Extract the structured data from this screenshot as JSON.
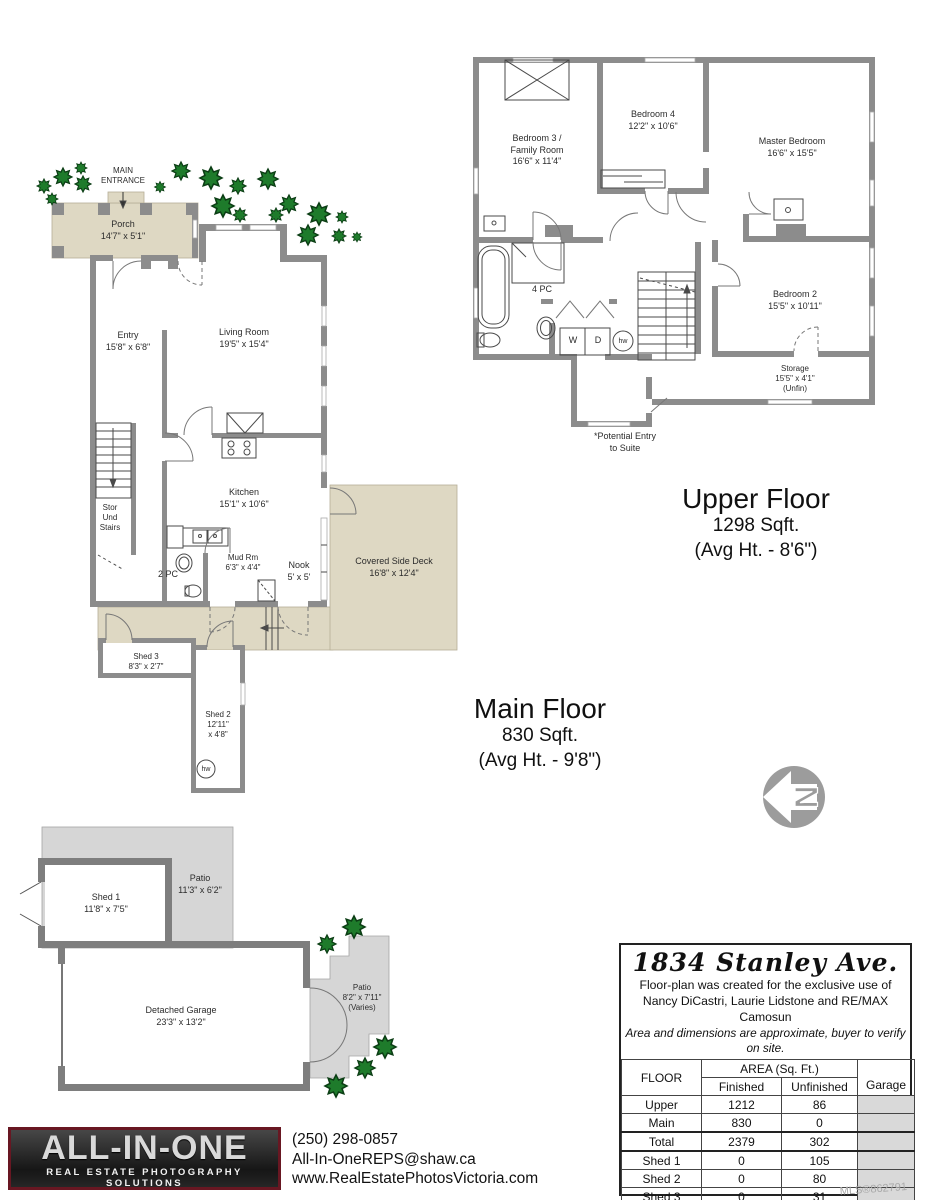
{
  "upper": {
    "caption": [
      "Upper Floor",
      "1298 Sqft.",
      "(Avg Ht. - 8'6\")"
    ],
    "rooms": {
      "bedroom3": [
        "Bedroom 3 /",
        "Family Room",
        "16'6\" x 11'4\""
      ],
      "bedroom4": [
        "Bedroom 4",
        "12'2\" x 10'6\""
      ],
      "master": [
        "Master Bedroom",
        "16'6\" x 15'5\""
      ],
      "bath": [
        "4 PC"
      ],
      "bedroom2": [
        "Bedroom 2",
        "15'5\" x 10'11\""
      ],
      "storage": [
        "Storage",
        "15'5\" x 4'1\"",
        "(Unfin)"
      ],
      "suite_note": [
        "*Potential Entry",
        "to Suite"
      ],
      "washer": "W",
      "dryer": "D",
      "hw": "hw"
    }
  },
  "main": {
    "caption": [
      "Main Floor",
      "830 Sqft.",
      "(Avg Ht. - 9'8\")"
    ],
    "rooms": {
      "entrance": [
        "MAIN",
        "ENTRANCE"
      ],
      "porch": [
        "Porch",
        "14'7\" x 5'1\""
      ],
      "entry": [
        "Entry",
        "15'8\" x 6'8\""
      ],
      "living": [
        "Living Room",
        "19'5\" x 15'4\""
      ],
      "kitchen": [
        "Kitchen",
        "15'1\" x 10'6\""
      ],
      "stor": [
        "Stor",
        "Und",
        "Stairs"
      ],
      "wc": [
        "2 PC"
      ],
      "mud": [
        "Mud Rm",
        "6'3\" x 4'4\""
      ],
      "nook": [
        "Nook",
        "5' x 5'"
      ],
      "deck": [
        "Covered Side Deck",
        "16'8\" x 12'4\""
      ],
      "shed3": [
        "Shed 3",
        "8'3\" x 2'7\""
      ],
      "shed2": [
        "Shed 2",
        "12'11\"",
        "x 4'8\""
      ],
      "hw": "hw"
    }
  },
  "garage_plan": {
    "rooms": {
      "shed1": [
        "Shed 1",
        "11'8\" x 7'5\""
      ],
      "patio1": [
        "Patio",
        "11'3\" x 6'2\""
      ],
      "garage": [
        "Detached Garage",
        "23'3\" x 13'2\""
      ],
      "patio2": [
        "Patio",
        "8'2\" x 7'11\"",
        "(Varies)"
      ]
    }
  },
  "compass": {
    "north": "N"
  },
  "address_table": {
    "title": "1834 Stanley Ave.",
    "disclaimer": [
      "Floor-plan was created for the exclusive use of",
      "Nancy DiCastri, Laurie Lidstone and RE/MAX Camosun",
      "Area and dimensions are approximate, buyer to verify on site."
    ],
    "header": {
      "floor": "FLOOR",
      "area": "AREA (Sq. Ft.)",
      "finished": "Finished",
      "unfinished": "Unfinished",
      "garage": "Garage"
    },
    "rows": [
      {
        "floor": "Upper",
        "finished": "1212",
        "unfinished": "86"
      },
      {
        "floor": "Main",
        "finished": "830",
        "unfinished": "0"
      },
      {
        "floor": "Total",
        "finished": "2379",
        "unfinished": "302"
      },
      {
        "floor": "Shed 1",
        "finished": "0",
        "unfinished": "105"
      },
      {
        "floor": "Shed 2",
        "finished": "0",
        "unfinished": "80"
      },
      {
        "floor": "Shed 3",
        "finished": "0",
        "unfinished": "31"
      },
      {
        "floor": "Det Garage",
        "finished": "337",
        "unfinished": "0"
      }
    ],
    "mls": "MLS®862791"
  },
  "footer": {
    "logo_title": "ALL-IN-ONE",
    "logo_subtitle": "REAL ESTATE PHOTOGRAPHY SOLUTIONS",
    "phone": "(250) 298-0857",
    "email": "All-In-OneREPS@shaw.ca",
    "website": "www.RealEstatePhotosVictoria.com"
  },
  "colors": {
    "wall": "#8c8c8c",
    "deck": "#ded8c3",
    "patio": "#d6d6d6",
    "tree": "#1e7b2b"
  }
}
